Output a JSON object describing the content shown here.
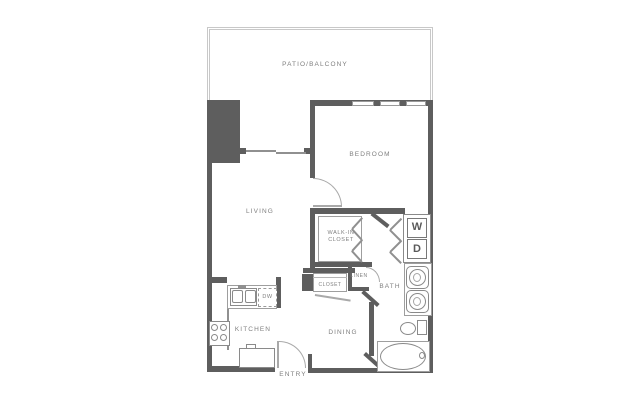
{
  "labels": {
    "patio": "PATIO/BALCONY",
    "bedroom": "BEDROOM",
    "living": "LIVING",
    "walk_in_closet": "WALK-IN CLOSET",
    "linen": "LINEN",
    "closet": "CLOSET",
    "bath": "BATH",
    "dining": "DINING",
    "kitchen": "KITCHEN",
    "entry": "ENTRY",
    "washer": "W",
    "dryer": "D",
    "dishwasher": "DW"
  },
  "colors": {
    "wall": "#5e5e5e",
    "fixture": "#909090",
    "label": "#7f7f7f",
    "patio": "#c8c8c8",
    "bg": "#ffffff"
  }
}
